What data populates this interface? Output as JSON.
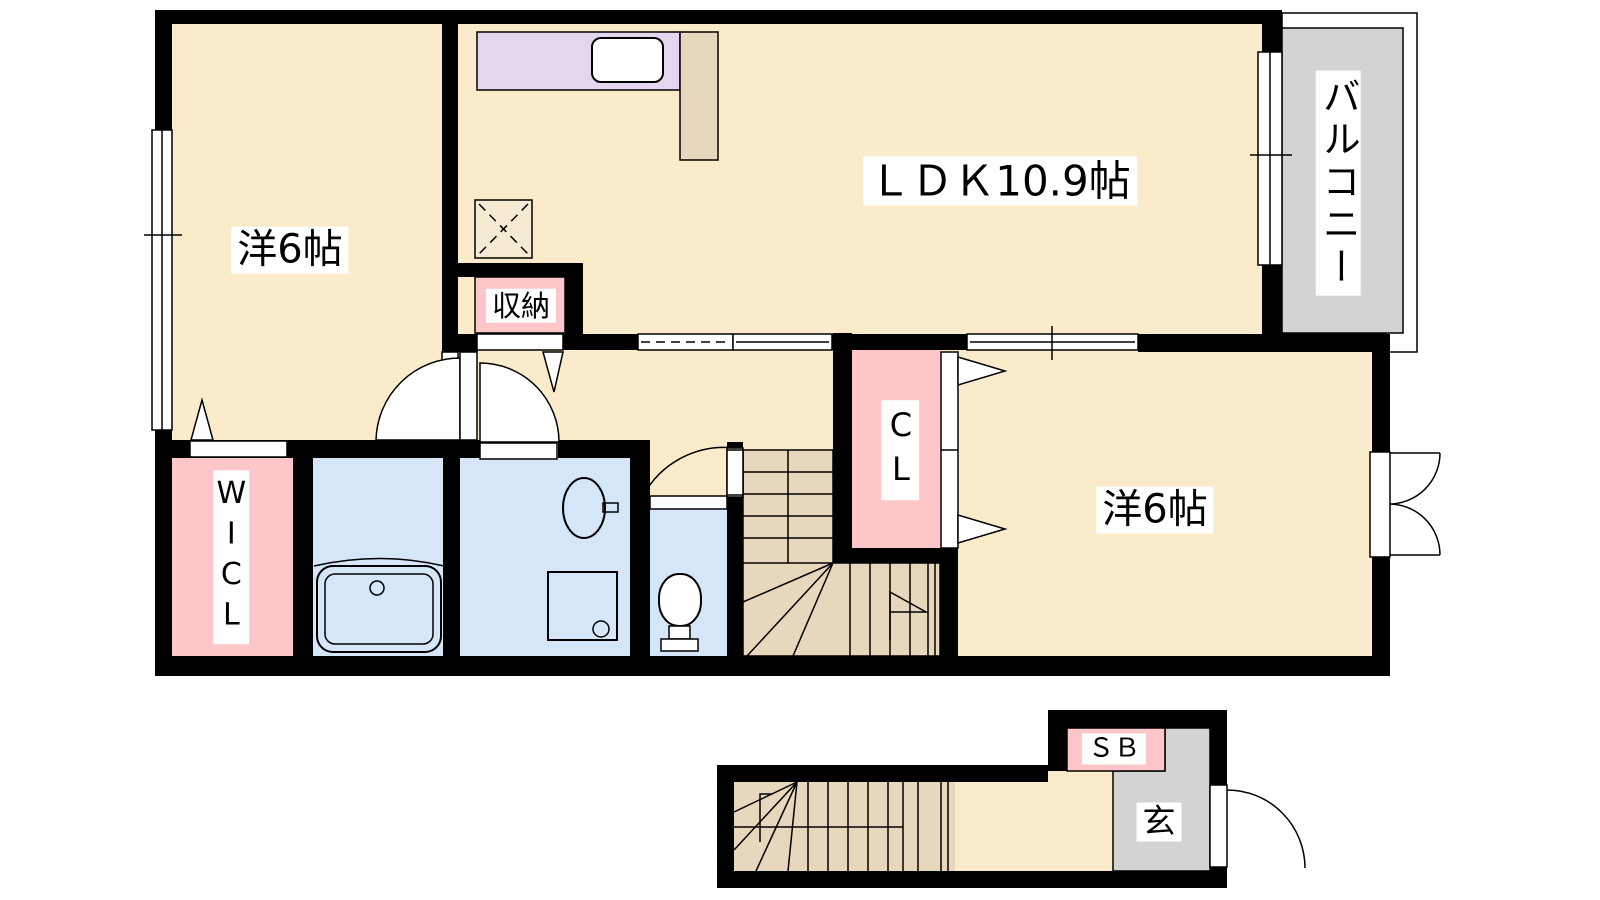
{
  "floor_plan": {
    "upper_floor": {
      "rooms": [
        {
          "id": "western_left",
          "label": "洋6帖"
        },
        {
          "id": "ldk",
          "label": "ＬＤＫ10.9帖"
        },
        {
          "id": "western_right",
          "label": "洋6帖"
        },
        {
          "id": "balcony",
          "label": "バルコニー"
        },
        {
          "id": "storage",
          "label": "収納"
        },
        {
          "id": "walk_in_closet",
          "label": "WICL"
        },
        {
          "id": "closet",
          "label": "CL"
        }
      ]
    },
    "lower_floor": {
      "rooms": [
        {
          "id": "shoe_box",
          "label": "ＳＢ"
        },
        {
          "id": "entrance",
          "label": "玄"
        }
      ]
    }
  },
  "colors": {
    "wall": "#000000",
    "floor": "#faeccb",
    "stairs": "#e7d7bc",
    "kitchen_counter": "#e4d6ee",
    "closet_pink": "#fdc7c9",
    "bath_blue": "#d5e6f8",
    "balcony_gray": "#d3d3d3",
    "label_bg": "#ffffff",
    "text": "#000000"
  }
}
